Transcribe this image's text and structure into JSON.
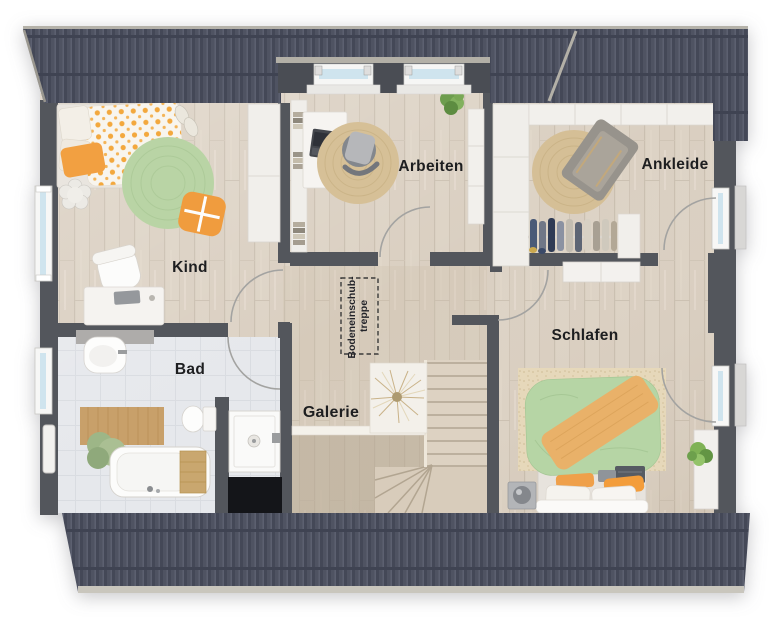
{
  "plan": {
    "type": "floorplan-top-view",
    "rooms": {
      "kind": {
        "label": "Kind"
      },
      "arbeiten": {
        "label": "Arbeiten"
      },
      "ankleide": {
        "label": "Ankleide"
      },
      "schlafen": {
        "label": "Schlafen"
      },
      "bad": {
        "label": "Bad"
      },
      "galerie": {
        "label": "Galerie"
      },
      "attic_hatch": {
        "label_line1": "Bodeneinschub-",
        "label_line2": "treppe"
      }
    },
    "colors": {
      "wall": "#53565c",
      "dormer_wall": "#4a4d54",
      "roof": "#4f5362",
      "roof_trim": "#b3b0a7",
      "wood_floor": "#ddd3c5",
      "galerie_floor_tint": "#cdbfa9",
      "tile_floor": "#e6e8ec",
      "accent_orange": "#f2a041",
      "accent_green": "#b9d4a5",
      "duvet_green": "#b6d5a5",
      "throw_orange": "#e9b169",
      "jute_rug": "#d5bf96",
      "window_glass": "#cfe4ee",
      "label_text": "#1d1e20",
      "floor_void": "#141519"
    }
  }
}
